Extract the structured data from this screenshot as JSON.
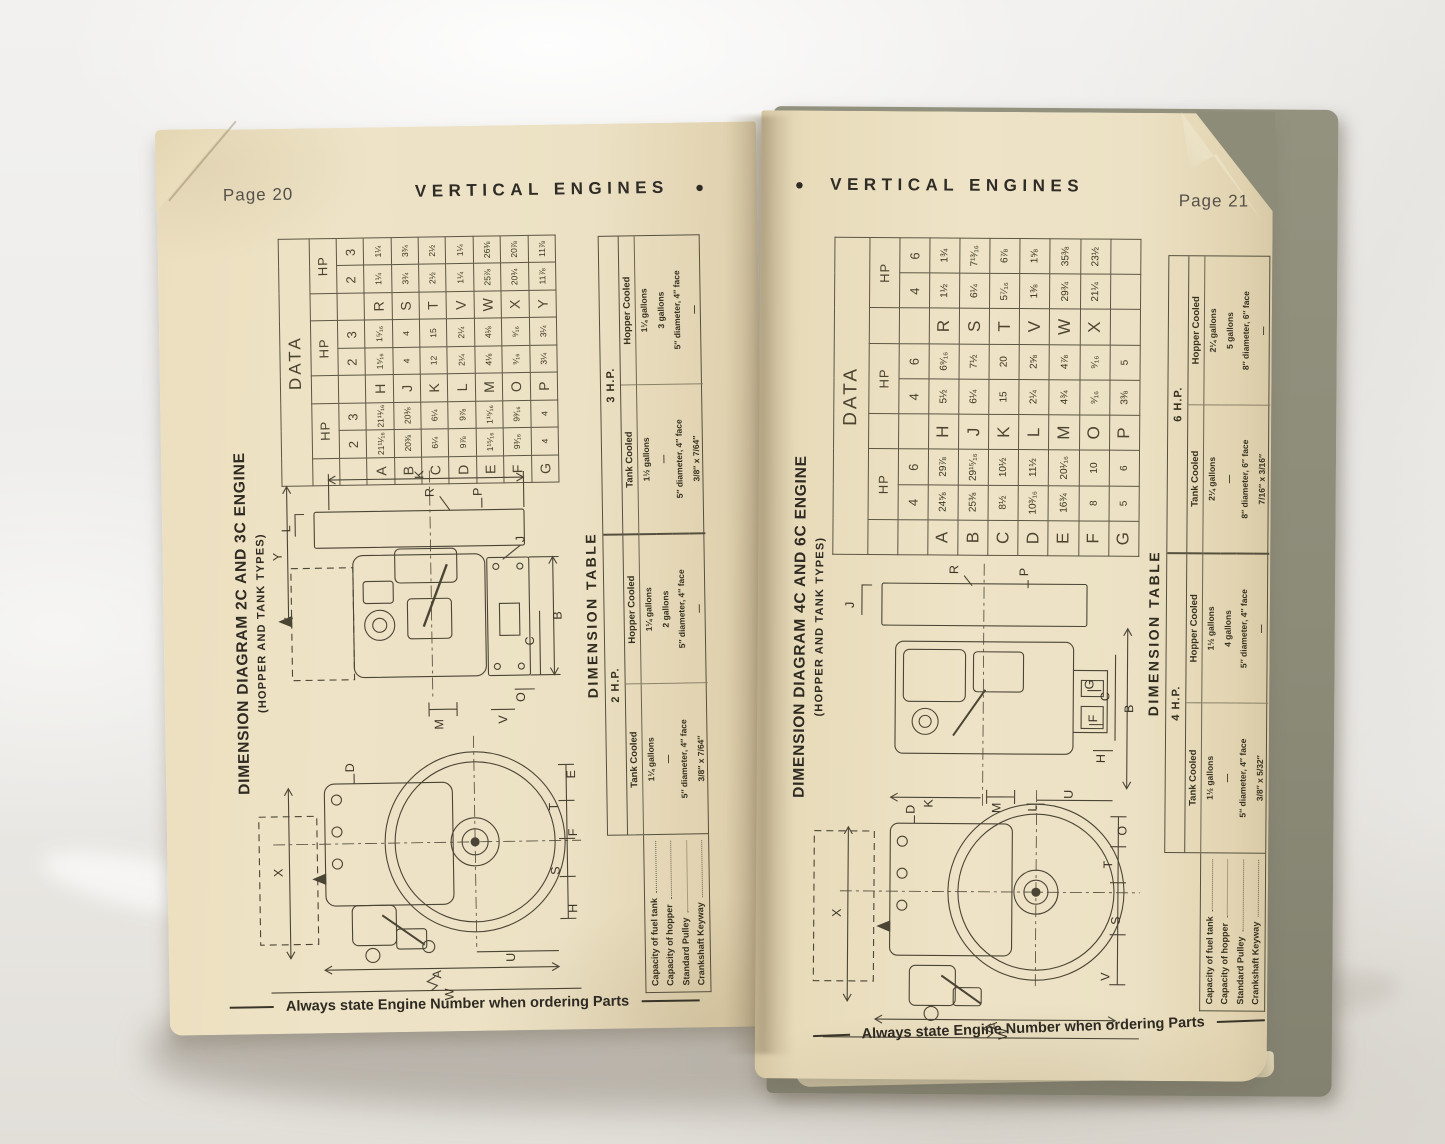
{
  "book": {
    "left_page": {
      "page_label": "Page 20",
      "running_title": "VERTICAL ENGINES",
      "bullet": "●",
      "title": "DIMENSION DIAGRAM 2C AND 3C ENGINE",
      "subtitle": "(HOPPER AND TANK TYPES)",
      "footer": "Always state Engine Number when ordering Parts",
      "data_table": {
        "title": "DATA",
        "hp_label": "HP",
        "hp_columns": [
          "2",
          "3"
        ],
        "groups": [
          [
            [
              "A",
              "21¹¹⁄₁₆",
              "21¹¹⁄₁₆"
            ],
            [
              "B",
              "20⅜",
              "20⅜"
            ],
            [
              "C",
              "6¼",
              "6¼"
            ],
            [
              "D",
              "9⅞",
              "9⅞"
            ],
            [
              "E",
              "1¹⁵⁄₁₆",
              "1¹⁵⁄₁₆"
            ],
            [
              "F",
              "9³⁄₁₆",
              "9³⁄₁₆"
            ],
            [
              "G",
              "4",
              "4"
            ]
          ],
          [
            [
              "H",
              "1⁵⁄₁₆",
              "1⁵⁄₁₆"
            ],
            [
              "J",
              "4",
              "4"
            ],
            [
              "K",
              "12",
              "15"
            ],
            [
              "L",
              "2¼",
              "2¼"
            ],
            [
              "M",
              "4⅛",
              "4⅛"
            ],
            [
              "O",
              "⁹⁄₁₆",
              "⁹⁄₁₆"
            ],
            [
              "P",
              "3¼",
              "3¼"
            ]
          ],
          [
            [
              "R",
              "1¼",
              "1¼"
            ],
            [
              "S",
              "3¾",
              "3¾"
            ],
            [
              "T",
              "2½",
              "2½"
            ],
            [
              "V",
              "1¼",
              "1¼"
            ],
            [
              "W",
              "25⅞",
              "26⅜"
            ],
            [
              "X",
              "20¾",
              "20⅞"
            ],
            [
              "Y",
              "11⅞",
              "11⅞"
            ]
          ]
        ]
      },
      "dimension_table": {
        "title": "DIMENSION TABLE",
        "row_labels": [
          "Capacity of fuel tank",
          "Capacity of hopper",
          "Standard Pulley",
          "Crankshaft Keyway"
        ],
        "sections": [
          {
            "hp": "2 H.P.",
            "cols": [
              {
                "head": "Tank Cooled",
                "values": [
                  "1¼ gallons",
                  "—",
                  "5″ diameter, 4″ face",
                  "3/8″ x 7/64″"
                ]
              },
              {
                "head": "Hopper Cooled",
                "values": [
                  "1¼ gallons",
                  "2 gallons",
                  "5″ diameter, 4″ face",
                  "—"
                ]
              }
            ]
          },
          {
            "hp": "3 H.P.",
            "cols": [
              {
                "head": "Tank Cooled",
                "values": [
                  "1½ gallons",
                  "—",
                  "5″ diameter, 4″ face",
                  "3/8″ x 7/64″"
                ]
              },
              {
                "head": "Hopper Cooled",
                "values": [
                  "1¼ gallons",
                  "3 gallons",
                  "5″ diameter, 4″ face",
                  "—"
                ]
              }
            ]
          }
        ]
      },
      "diagram_labels_upper": [
        "K",
        "R",
        "P",
        "L",
        "Y",
        "B",
        "C",
        "J",
        "O",
        "V",
        "M"
      ],
      "diagram_labels_lower": [
        "X",
        "A",
        "U",
        "W",
        "E",
        "T",
        "F",
        "S",
        "H",
        "D"
      ]
    },
    "right_page": {
      "page_label": "Page 21",
      "running_title": "VERTICAL ENGINES",
      "bullet": "●",
      "title": "DIMENSION DIAGRAM 4C AND 6C ENGINE",
      "subtitle": "(HOPPER AND TANK TYPES)",
      "footer": "Always state Engine Number when ordering Parts",
      "data_table": {
        "title": "DATA",
        "hp_label": "HP",
        "hp_columns": [
          "4",
          "6"
        ],
        "groups": [
          [
            [
              "A",
              "24⅝",
              "29⅞"
            ],
            [
              "B",
              "25⅜",
              "29¹⁵⁄₁₆"
            ],
            [
              "C",
              "8½",
              "10½"
            ],
            [
              "D",
              "10³⁄₁₆",
              "11½"
            ],
            [
              "E",
              "16¾",
              "20¹⁄₁₆"
            ],
            [
              "F",
              "8",
              "10"
            ],
            [
              "G",
              "5",
              "6"
            ]
          ],
          [
            [
              "H",
              "5½",
              "6⁹⁄₁₆"
            ],
            [
              "J",
              "6¼",
              "7½"
            ],
            [
              "K",
              "15",
              "20"
            ],
            [
              "L",
              "2¼",
              "2⅝"
            ],
            [
              "M",
              "4¾",
              "4⅞"
            ],
            [
              "O",
              "⁹⁄₁₆",
              "⁹⁄₁₆"
            ],
            [
              "P",
              "3⅜",
              "5"
            ]
          ],
          [
            [
              "R",
              "1½",
              "1¾"
            ],
            [
              "S",
              "6¼",
              "7¹³⁄₁₆"
            ],
            [
              "T",
              "5⁷⁄₁₆",
              "6⅞"
            ],
            [
              "V",
              "1⅜",
              "1⅝"
            ],
            [
              "W",
              "29¾",
              "35⅜"
            ],
            [
              "X",
              "21¼",
              "23½"
            ],
            [
              "",
              "",
              ""
            ]
          ]
        ]
      },
      "dimension_table": {
        "title": "DIMENSION TABLE",
        "row_labels": [
          "Capacity of fuel tank",
          "Capacity of hopper",
          "Standard Pulley",
          "Crankshaft Keyway"
        ],
        "sections": [
          {
            "hp": "4 H.P.",
            "cols": [
              {
                "head": "Tank Cooled",
                "values": [
                  "1½ gallons",
                  "—",
                  "5″ diameter, 4″ face",
                  "3/8″ x 5/32″"
                ]
              },
              {
                "head": "Hopper Cooled",
                "values": [
                  "1½ gallons",
                  "4 gallons",
                  "5″ diameter, 4″ face",
                  "—"
                ]
              }
            ]
          },
          {
            "hp": "6 H.P.",
            "cols": [
              {
                "head": "Tank Cooled",
                "values": [
                  "2¼ gallons",
                  "—",
                  "8″ diameter, 6″ face",
                  "7/16″ x 3/16″"
                ]
              },
              {
                "head": "Hopper Cooled",
                "values": [
                  "2¼ gallons",
                  "5 gallons",
                  "8″ diameter, 6″ face",
                  "—"
                ]
              }
            ]
          }
        ]
      },
      "diagram_labels_upper": [
        "R",
        "P",
        "J",
        "B",
        "C",
        "G",
        "F",
        "H",
        "K",
        "M",
        "L"
      ],
      "diagram_labels_lower": [
        "X",
        "D",
        "U",
        "O",
        "T",
        "S",
        "V",
        "A",
        "W"
      ]
    }
  }
}
